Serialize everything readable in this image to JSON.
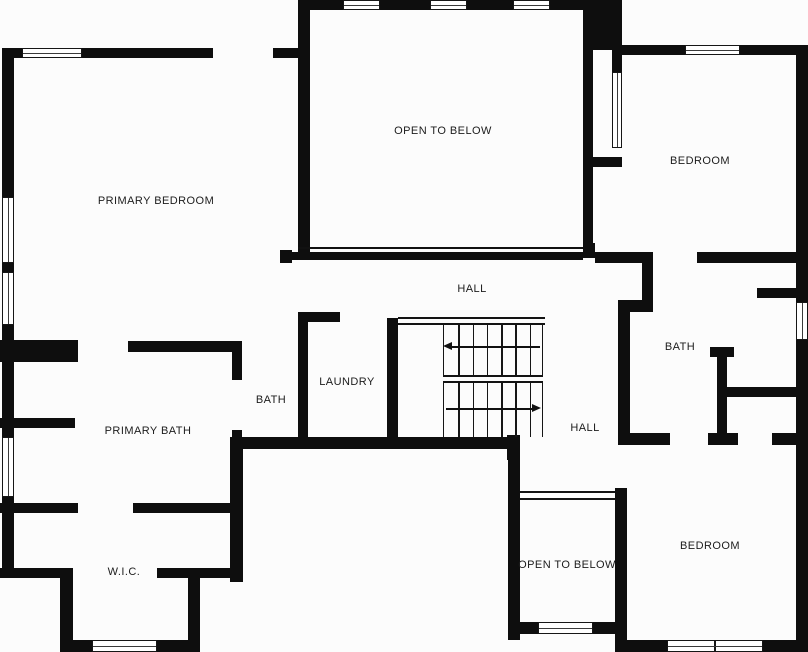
{
  "colors": {
    "wall": "#0e0e0e",
    "background": "#fcfcfc",
    "label_text": "#1c1c1c"
  },
  "rooms": [
    {
      "id": "primary-bedroom",
      "label": "PRIMARY BEDROOM",
      "x": 156,
      "y": 201
    },
    {
      "id": "open-to-below-top",
      "label": "OPEN TO BELOW",
      "x": 443,
      "y": 131
    },
    {
      "id": "bedroom-top-right",
      "label": "BEDROOM",
      "x": 700,
      "y": 161
    },
    {
      "id": "hall-top",
      "label": "HALL",
      "x": 472,
      "y": 289
    },
    {
      "id": "laundry",
      "label": "LAUNDRY",
      "x": 347,
      "y": 382
    },
    {
      "id": "bath-middle",
      "label": "BATH",
      "x": 271,
      "y": 400
    },
    {
      "id": "primary-bath",
      "label": "PRIMARY BATH",
      "x": 148,
      "y": 431
    },
    {
      "id": "bath-right",
      "label": "BATH",
      "x": 680,
      "y": 347
    },
    {
      "id": "hall-right",
      "label": "HALL",
      "x": 585,
      "y": 428
    },
    {
      "id": "wic",
      "label": "W.I.C.",
      "x": 124,
      "y": 572
    },
    {
      "id": "open-to-below-bottom",
      "label": "OPEN TO BELOW",
      "x": 567,
      "y": 565
    },
    {
      "id": "bedroom-bottom-right",
      "label": "BEDROOM",
      "x": 710,
      "y": 546
    }
  ],
  "plan": {
    "walls": [
      [
        298,
        0,
        324,
        10
      ],
      [
        583,
        0,
        39,
        50
      ],
      [
        298,
        0,
        12,
        258
      ],
      [
        5,
        48,
        208,
        10
      ],
      [
        273,
        48,
        27,
        10
      ],
      [
        2,
        48,
        12,
        530
      ],
      [
        0,
        340,
        78,
        22
      ],
      [
        128,
        341,
        114,
        11
      ],
      [
        0,
        418,
        75,
        10
      ],
      [
        0,
        503,
        78,
        10
      ],
      [
        133,
        503,
        100,
        10
      ],
      [
        0,
        568,
        63,
        10
      ],
      [
        60,
        568,
        13,
        84
      ],
      [
        60,
        640,
        140,
        12
      ],
      [
        188,
        578,
        12,
        74
      ],
      [
        157,
        568,
        86,
        10
      ],
      [
        230,
        437,
        13,
        145
      ],
      [
        232,
        348,
        10,
        32
      ],
      [
        232,
        430,
        10,
        12
      ],
      [
        298,
        312,
        10,
        126
      ],
      [
        302,
        312,
        38,
        10
      ],
      [
        232,
        437,
        286,
        12
      ],
      [
        507,
        435,
        13,
        25
      ],
      [
        387,
        318,
        11,
        119
      ],
      [
        280,
        250,
        12,
        13
      ],
      [
        292,
        252,
        291,
        8
      ],
      [
        583,
        243,
        12,
        15
      ],
      [
        583,
        50,
        10,
        208
      ],
      [
        612,
        45,
        10,
        27
      ],
      [
        583,
        157,
        39,
        10
      ],
      [
        612,
        45,
        196,
        10
      ],
      [
        796,
        45,
        12,
        607
      ],
      [
        595,
        252,
        58,
        11
      ],
      [
        697,
        252,
        111,
        11
      ],
      [
        642,
        252,
        11,
        60
      ],
      [
        618,
        300,
        35,
        12
      ],
      [
        618,
        300,
        12,
        142
      ],
      [
        618,
        433,
        52,
        12
      ],
      [
        708,
        433,
        30,
        12
      ],
      [
        717,
        347,
        10,
        98
      ],
      [
        710,
        347,
        24,
        10
      ],
      [
        772,
        433,
        26,
        12
      ],
      [
        722,
        387,
        76,
        10
      ],
      [
        757,
        288,
        51,
        10
      ],
      [
        508,
        437,
        12,
        203
      ],
      [
        615,
        488,
        12,
        164
      ],
      [
        508,
        622,
        119,
        12
      ],
      [
        615,
        640,
        193,
        12
      ]
    ],
    "windows": [
      {
        "x": 343,
        "y": 0,
        "w": 37,
        "h": 10,
        "o": "h",
        "double": false
      },
      {
        "x": 430,
        "y": 0,
        "w": 37,
        "h": 10,
        "o": "h",
        "double": false
      },
      {
        "x": 513,
        "y": 0,
        "w": 37,
        "h": 10,
        "o": "h",
        "double": false
      },
      {
        "x": 22,
        "y": 48,
        "w": 60,
        "h": 10,
        "o": "h",
        "double": false
      },
      {
        "x": 685,
        "y": 45,
        "w": 55,
        "h": 10,
        "o": "h",
        "double": false
      },
      {
        "x": 2,
        "y": 197,
        "w": 12,
        "h": 66,
        "o": "v",
        "double": false
      },
      {
        "x": 2,
        "y": 272,
        "w": 12,
        "h": 53,
        "o": "v",
        "double": false
      },
      {
        "x": 2,
        "y": 437,
        "w": 12,
        "h": 60,
        "o": "v",
        "double": false
      },
      {
        "x": 92,
        "y": 640,
        "w": 65,
        "h": 12,
        "o": "h",
        "double": false
      },
      {
        "x": 538,
        "y": 622,
        "w": 55,
        "h": 12,
        "o": "h",
        "double": false
      },
      {
        "x": 667,
        "y": 640,
        "w": 96,
        "h": 12,
        "o": "h",
        "double": true
      },
      {
        "x": 796,
        "y": 302,
        "w": 12,
        "h": 38,
        "o": "v",
        "double": false
      },
      {
        "x": 612,
        "y": 72,
        "w": 10,
        "h": 76,
        "o": "v",
        "double": false
      }
    ],
    "railings": [
      {
        "x": 298,
        "y": 247,
        "w": 285,
        "h": 2,
        "style": "line"
      },
      {
        "x": 398,
        "y": 317,
        "w": 147,
        "h": 8,
        "style": "double"
      },
      {
        "x": 520,
        "y": 491,
        "w": 95,
        "h": 9,
        "style": "double"
      }
    ],
    "stairs": {
      "flights": [
        {
          "x": 443,
          "y": 325,
          "w": 100,
          "h": 50,
          "treads": 7
        },
        {
          "x": 443,
          "y": 383,
          "w": 100,
          "h": 54,
          "treads": 7
        }
      ],
      "divider": {
        "x": 443,
        "y": 375,
        "w": 100,
        "h": 8
      },
      "arrows": [
        {
          "x": 452,
          "y": 346,
          "len": 88,
          "dir": "left"
        },
        {
          "x": 446,
          "y": 408,
          "len": 86,
          "dir": "right"
        }
      ]
    }
  }
}
